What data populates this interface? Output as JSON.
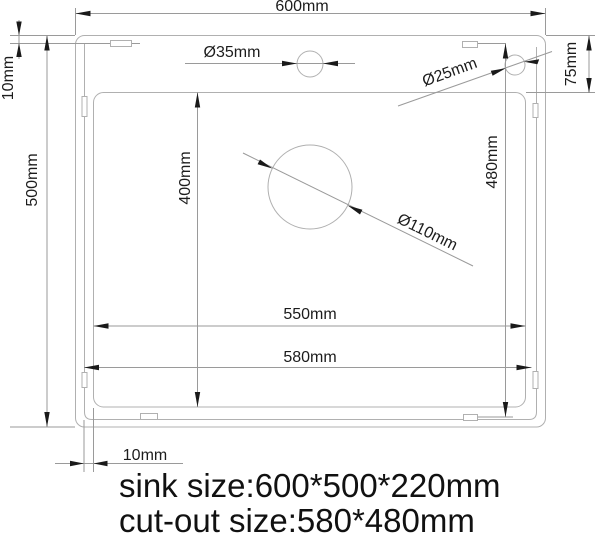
{
  "drawing": {
    "labels": {
      "overall_width": "600mm",
      "rim_offset_top": "10mm",
      "overall_height": "500mm",
      "faucet_hole_diameter": "Ø35mm",
      "accessory_hole_diameter": "Ø25mm",
      "top_edge_to_basin": "75mm",
      "basin_height": "400mm",
      "cutout_height": "480mm",
      "drain_hole_diameter": "Ø110mm",
      "basin_width": "550mm",
      "cutout_width": "580mm",
      "rim_offset_bottom": "10mm"
    },
    "caption": {
      "line1": "sink size:600*500*220mm",
      "line2": "cut-out size:580*480mm"
    }
  }
}
